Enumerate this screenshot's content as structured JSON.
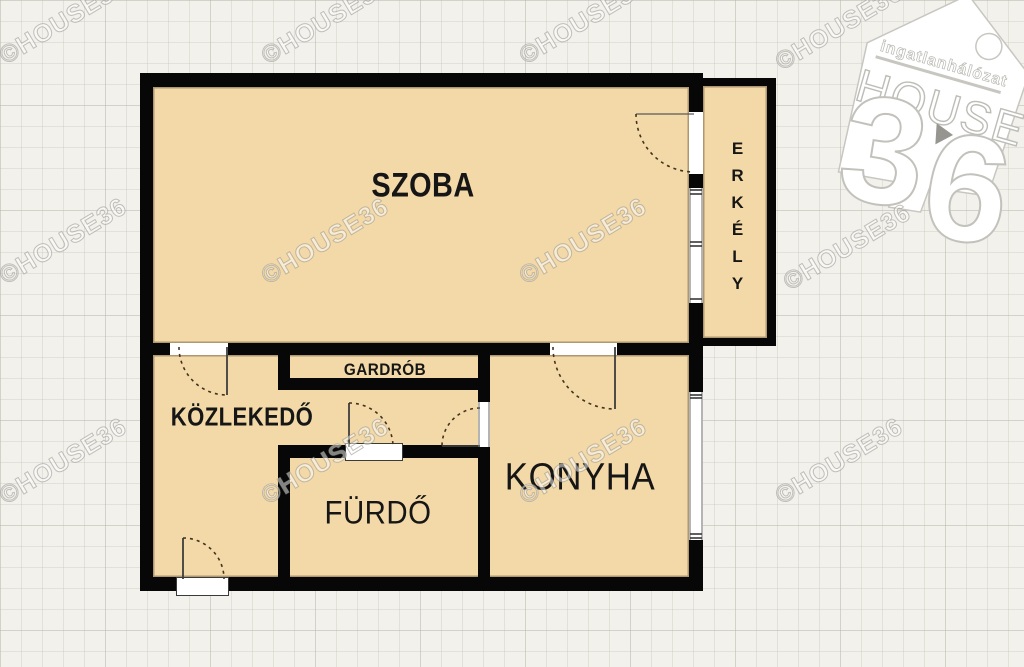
{
  "floor_plan": {
    "rooms": [
      {
        "id": "szoba",
        "label": "SZOBA"
      },
      {
        "id": "erkely",
        "label": "ERKÉLY"
      },
      {
        "id": "gardrob",
        "label": "GARDRÓB"
      },
      {
        "id": "kozlekedo",
        "label": "KÖZLEKEDŐ"
      },
      {
        "id": "furdo",
        "label": "FÜRDŐ"
      },
      {
        "id": "konyha",
        "label": "KONYHA"
      }
    ]
  },
  "watermark": {
    "prefix": "©HOUSE",
    "suffix": "36"
  },
  "logo": {
    "tagline": "ingatlanhálózat",
    "brand": "HOUSE",
    "digit1": "3",
    "digit2": "6"
  },
  "colors": {
    "room_fill": "#f3d9a8",
    "wall": "#070707",
    "background": "#f2f1ec",
    "label_text": "#161616",
    "watermark_stroke": "#94928a"
  }
}
